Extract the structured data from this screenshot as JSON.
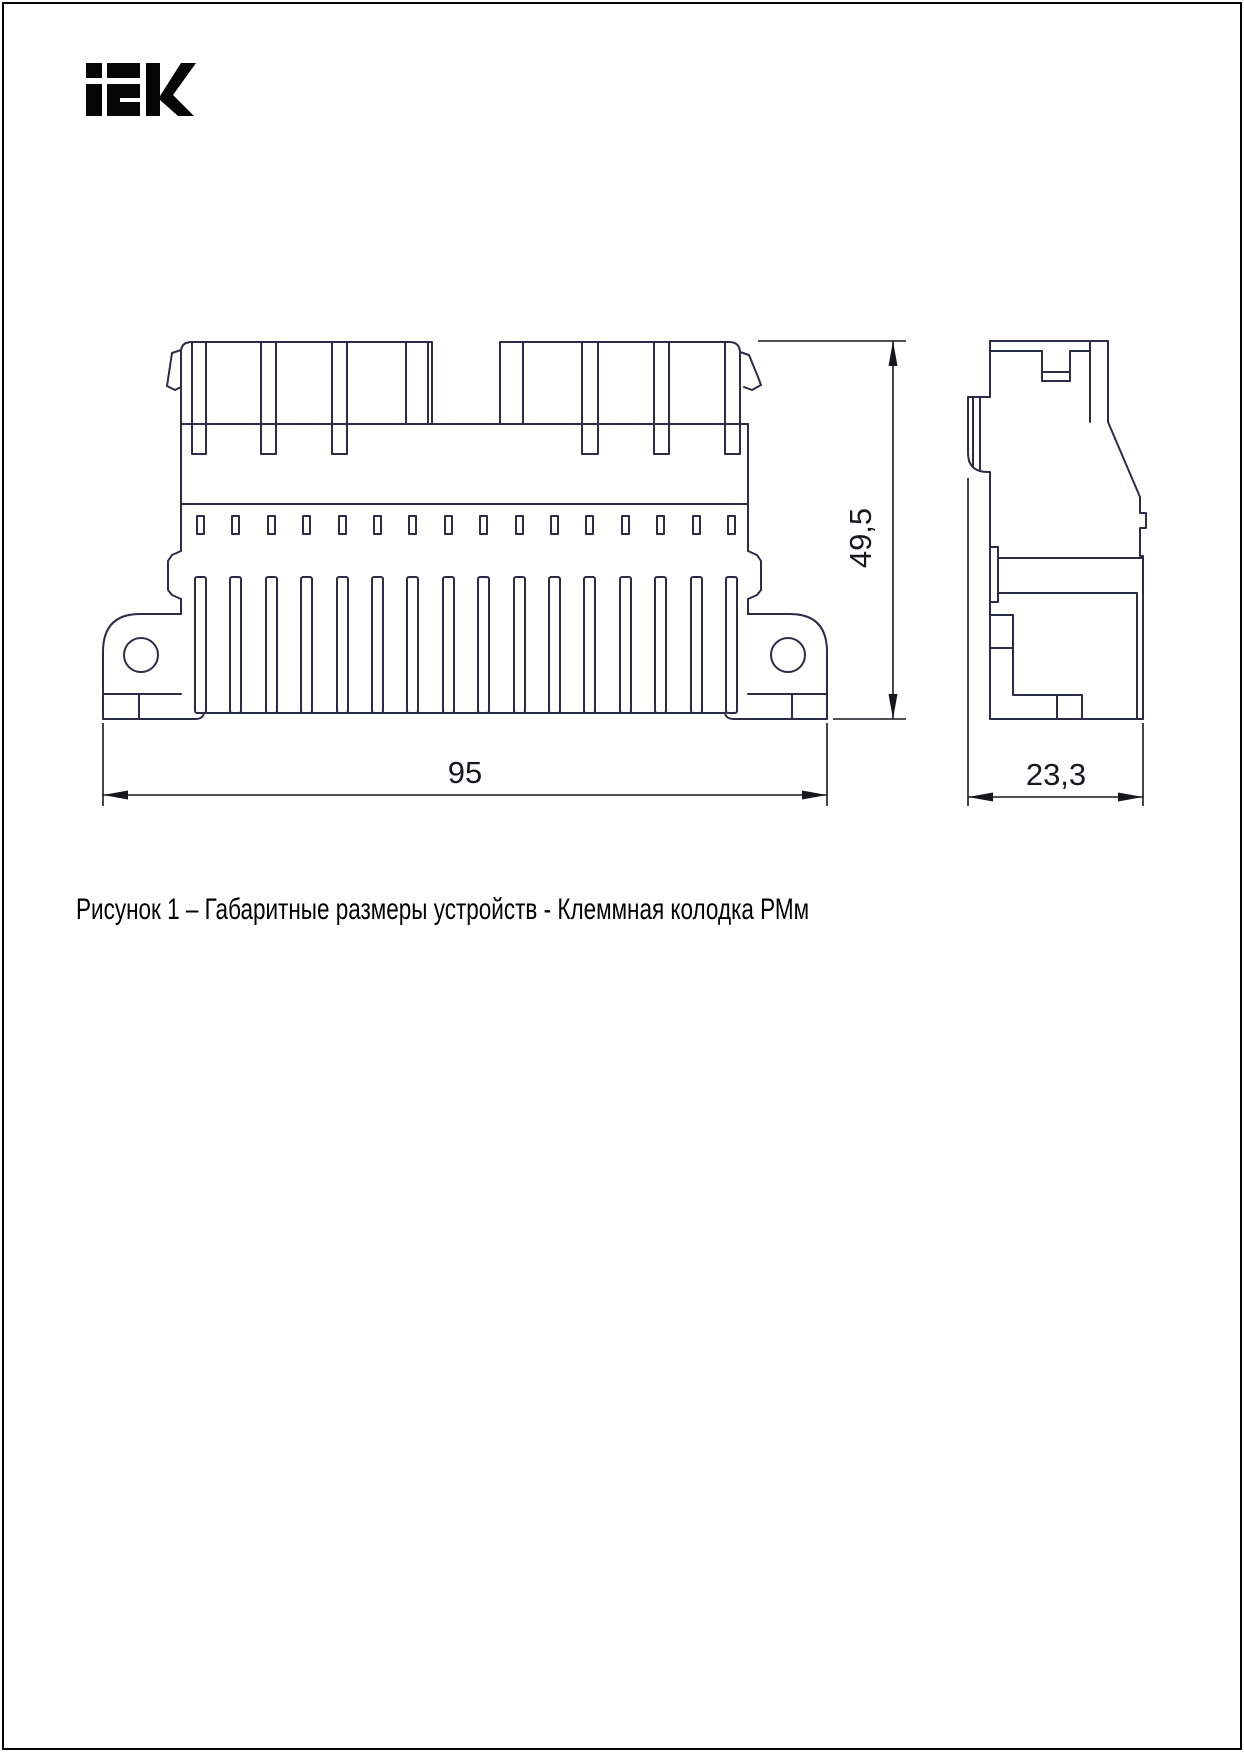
{
  "logo": {
    "text": "IEK"
  },
  "figure": {
    "caption": "Рисунок 1 – Габаритные размеры устройств - Клеммная колодка РМм"
  },
  "dimensions": {
    "width_mm": "95",
    "height_mm": "49,5",
    "depth_mm": "23,3"
  },
  "drawing": {
    "type": "engineering dimensional drawing",
    "views": 2,
    "front_view_slots": 16,
    "front_view_fins": 16,
    "line_color": "#2b2d47",
    "dimension_color": "#17171e",
    "background": "#ffffff"
  }
}
